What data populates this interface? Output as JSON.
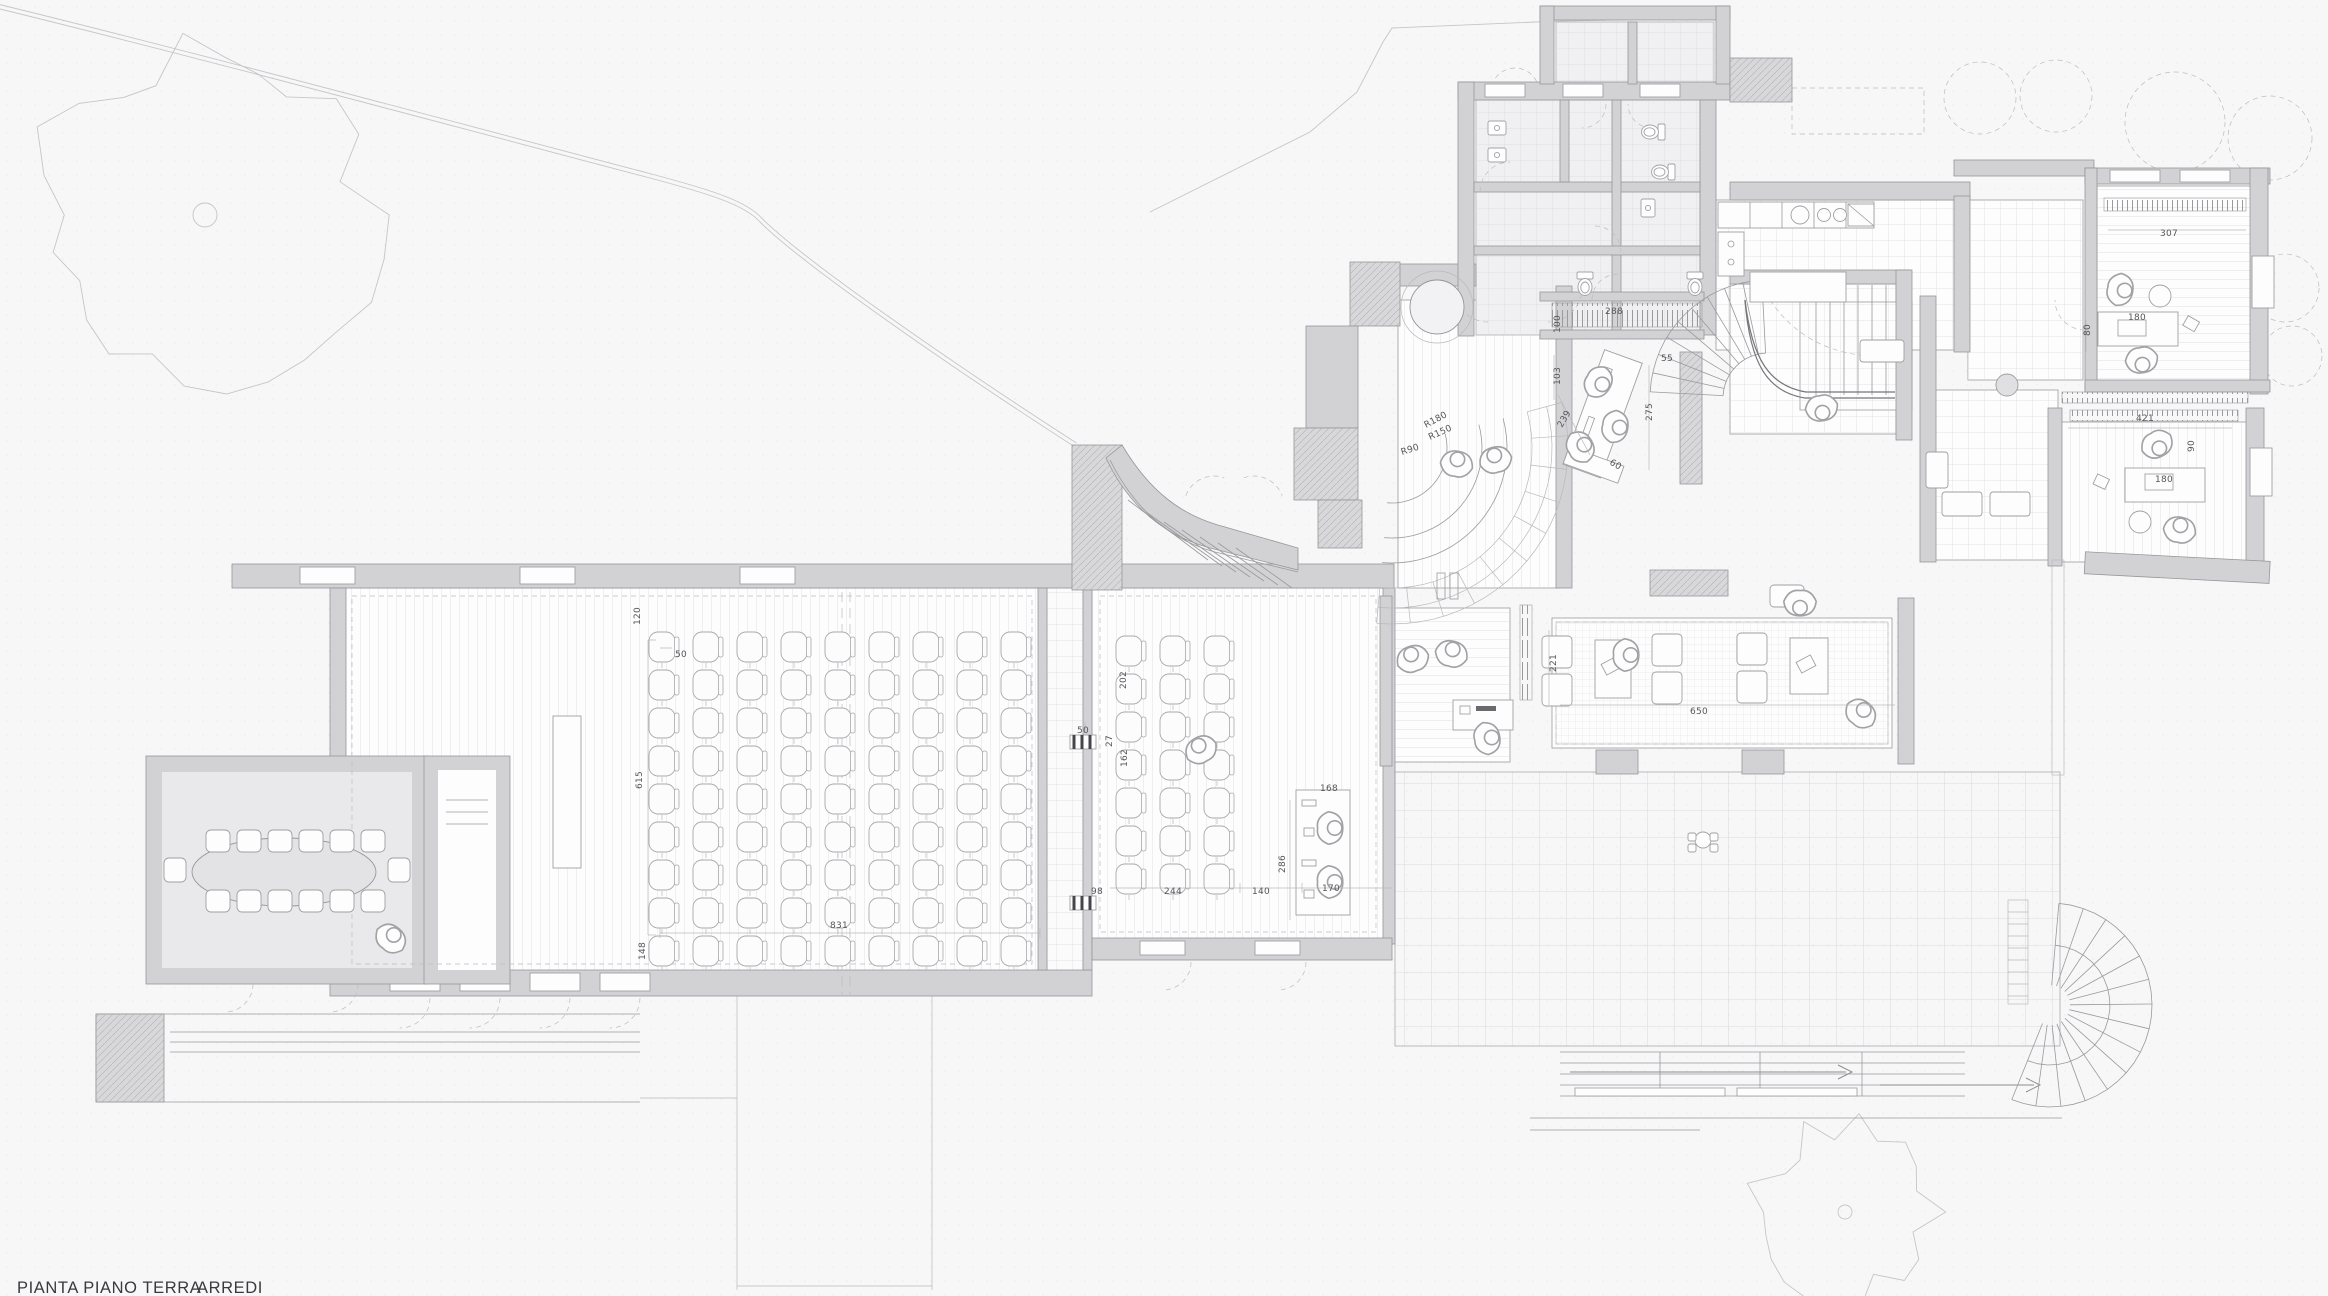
{
  "drawing": {
    "title": "PIANTA PIANO TERRA",
    "subtitle": "ARREDI"
  },
  "colors": {
    "background": "#f7f7f8",
    "wall_fill": "#d2d2d5",
    "line": "#96969a",
    "floor_line": "#cfcfd2",
    "carpet": "#e9e9eb",
    "label_text": "#55555a",
    "title_text": "#3a3a3e"
  },
  "labels": [
    {
      "text": "307"
    },
    {
      "text": "80"
    },
    {
      "text": "180"
    },
    {
      "text": "421"
    },
    {
      "text": "90"
    },
    {
      "text": "180"
    },
    {
      "text": "288"
    },
    {
      "text": "100"
    },
    {
      "text": "55"
    },
    {
      "text": "103"
    },
    {
      "text": "239"
    },
    {
      "text": "60"
    },
    {
      "text": "275"
    },
    {
      "text": "R180"
    },
    {
      "text": "R150"
    },
    {
      "text": "R90"
    },
    {
      "text": "202"
    },
    {
      "text": "162"
    },
    {
      "text": "27"
    },
    {
      "text": "50"
    },
    {
      "text": "98"
    },
    {
      "text": "244"
    },
    {
      "text": "140"
    },
    {
      "text": "168"
    },
    {
      "text": "286"
    },
    {
      "text": "170"
    },
    {
      "text": "120"
    },
    {
      "text": "50"
    },
    {
      "text": "615"
    },
    {
      "text": "148"
    },
    {
      "text": "831"
    },
    {
      "text": "221"
    },
    {
      "text": "650"
    }
  ]
}
